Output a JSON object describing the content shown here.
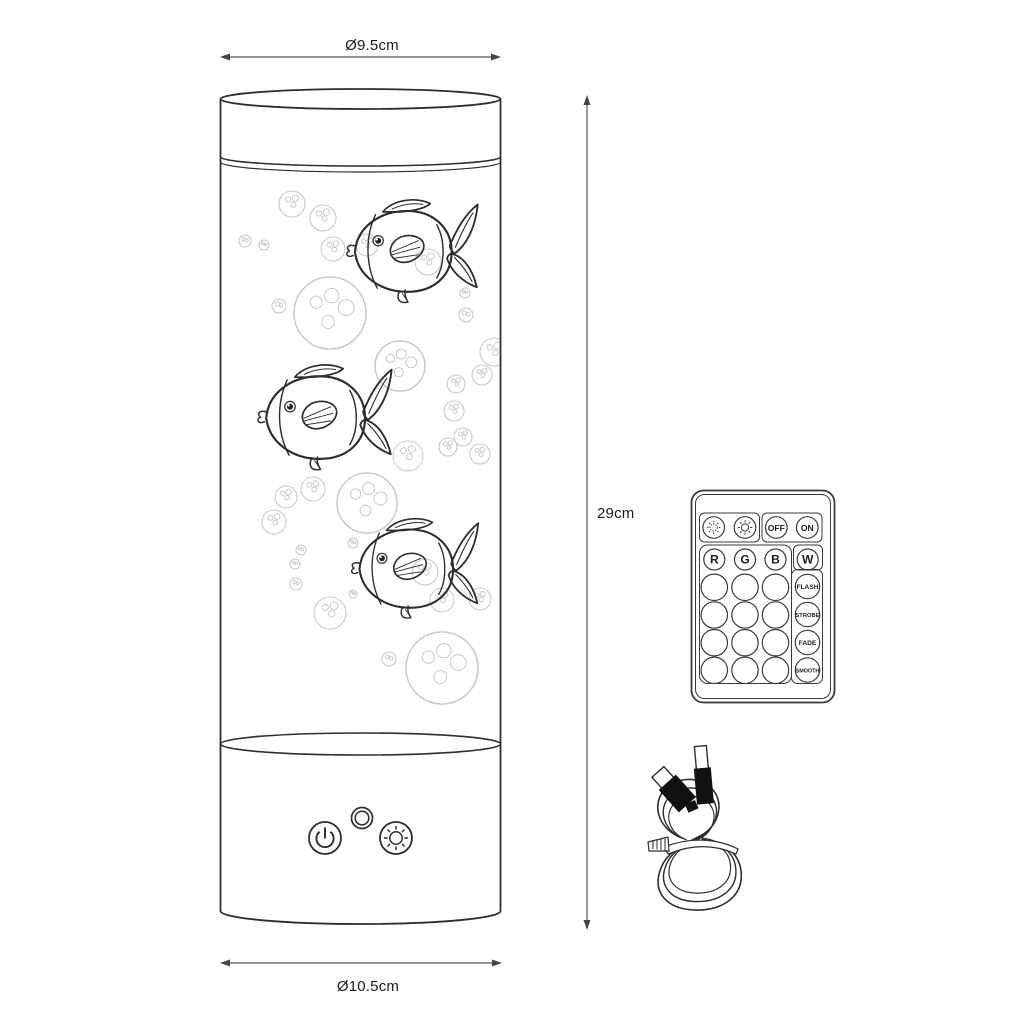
{
  "dimensions": {
    "top_diameter": "Ø9.5cm",
    "height": "29cm",
    "bottom_diameter": "Ø10.5cm"
  },
  "remote": {
    "power_row": {
      "brightness_down_icon": "sun-dim-icon",
      "brightness_up_icon": "sun-bright-icon",
      "off": "OFF",
      "on": "ON"
    },
    "color_row": {
      "r": "R",
      "g": "G",
      "b": "B",
      "w": "W"
    },
    "modes": [
      "FLASH",
      "STROBE",
      "FADE",
      "SMOOTH"
    ],
    "blank_grid": {
      "rows": 4,
      "cols": 3
    }
  },
  "base_controls": {
    "power_button_icon": "power-icon",
    "ir_sensor_icon": "ir-sensor-icon",
    "brightness_button_icon": "sun-icon"
  },
  "accessories": {
    "cable_icon": "usb-cable-icon"
  },
  "colors": {
    "line": "#2d2d2d",
    "dim_line": "#555555",
    "bubble_line": "#c9c9c9",
    "background": "#ffffff",
    "label_text": "#1c1c1c"
  }
}
